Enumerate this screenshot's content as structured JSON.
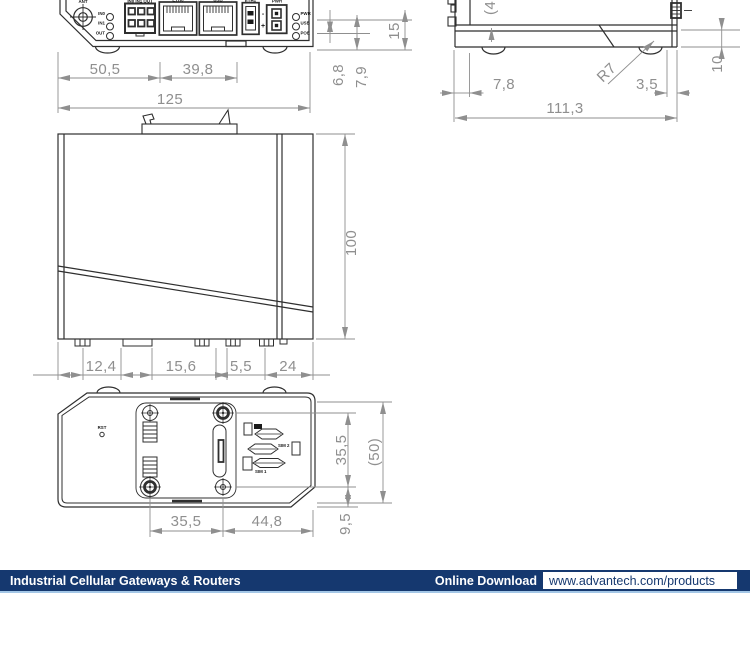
{
  "front_view": {
    "dims": {
      "seg1": "50,5",
      "seg2": "39,8",
      "total": "125",
      "h1": "6,8",
      "h2": "7,9",
      "h3": "15"
    },
    "labels": {
      "ant": "ANT",
      "io_header": "IN0 IN1 OUT",
      "in0": "IN0",
      "in1": "IN1",
      "out": "OUT",
      "eth0": "ETH0",
      "eth1": "ETH1",
      "usb": "USB",
      "pwr": "PWR",
      "minus": "-",
      "plus": "+",
      "led_pwr": "PWR",
      "led_usb": "USB",
      "led_poe": "POE"
    }
  },
  "side_view": {
    "dims": {
      "d1": "7,8",
      "d2": "3,5",
      "total": "111,3",
      "radius": "R7",
      "height": "10",
      "groove": "(4"
    }
  },
  "top_view": {
    "dims": {
      "depth": "100",
      "b1": "12,4",
      "b2": "15,6",
      "b3": "5,5",
      "b4": "24"
    }
  },
  "bottom_view": {
    "dims": {
      "v1": "35,5",
      "v2": "(50)",
      "v3": "9,5",
      "h1": "35,5",
      "h2": "44,8"
    },
    "labels": {
      "rst": "RST",
      "sim2": "SIM 2",
      "sim1": "SIM 1"
    }
  },
  "footer": {
    "title": "Industrial Cellular Gateways & Routers",
    "download_label": "Online Download",
    "url": "www.advantech.com/products",
    "bar_color": "#15386f",
    "rule_color": "#a3c6e6",
    "text_color": "#ffffff"
  }
}
